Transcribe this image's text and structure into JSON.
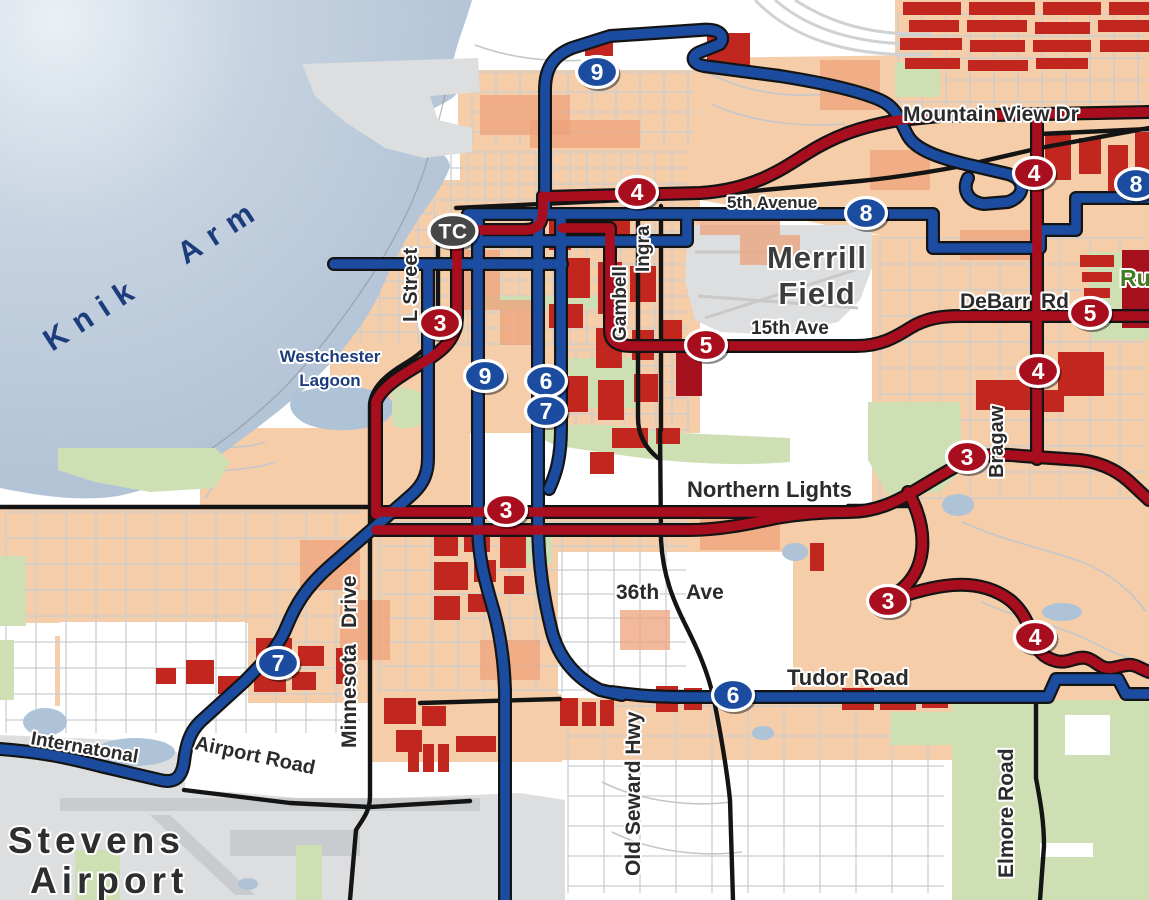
{
  "map": {
    "water": {
      "label": "Knik Arm",
      "color": "#b7c7d8"
    },
    "transit_center": {
      "label": "TC",
      "x": 453,
      "y": 231
    },
    "colors": {
      "route_red": "#a90e1e",
      "route_blue": "#1b4c9f",
      "casing_black": "#141414",
      "land_peach": "#f5cda9",
      "block_red": "#c1271f",
      "block_dark_red": "#a5121d",
      "park_green": "#cfdfb4",
      "water_blue": "#b7c7d8",
      "label_dark": "#2b2b2b",
      "label_navy": "#1d3c7c",
      "label_green": "#3e7c1f"
    },
    "route_badges": [
      {
        "route": "9",
        "color": "blue",
        "x": 597,
        "y": 72
      },
      {
        "route": "4",
        "color": "red",
        "x": 637,
        "y": 192
      },
      {
        "route": "8",
        "color": "blue",
        "x": 866,
        "y": 213
      },
      {
        "route": "8",
        "color": "blue",
        "x": 1136,
        "y": 184
      },
      {
        "route": "4",
        "color": "red",
        "x": 1034,
        "y": 173
      },
      {
        "route": "3",
        "color": "red",
        "x": 440,
        "y": 323
      },
      {
        "route": "5",
        "color": "red",
        "x": 706,
        "y": 345
      },
      {
        "route": "5",
        "color": "red",
        "x": 1090,
        "y": 313
      },
      {
        "route": "9",
        "color": "blue",
        "x": 485,
        "y": 376
      },
      {
        "route": "6",
        "color": "blue",
        "x": 546,
        "y": 381
      },
      {
        "route": "7",
        "color": "blue",
        "x": 546,
        "y": 411
      },
      {
        "route": "4",
        "color": "red",
        "x": 1038,
        "y": 371
      },
      {
        "route": "3",
        "color": "red",
        "x": 967,
        "y": 457
      },
      {
        "route": "3",
        "color": "red",
        "x": 506,
        "y": 510
      },
      {
        "route": "3",
        "color": "red",
        "x": 888,
        "y": 601
      },
      {
        "route": "4",
        "color": "red",
        "x": 1035,
        "y": 637
      },
      {
        "route": "7",
        "color": "blue",
        "x": 278,
        "y": 663
      },
      {
        "route": "6",
        "color": "blue",
        "x": 733,
        "y": 695
      }
    ],
    "place_labels": [
      {
        "id": "knik-arm",
        "text": "Knik Arm",
        "x": 52,
        "y": 352,
        "rotate": -33,
        "size": 31,
        "color": "#1d3c7c",
        "ls": 11,
        "ws": 30,
        "halo": false
      },
      {
        "id": "westchester-lagoon-1",
        "text": "Westchester",
        "x": 330,
        "y": 362,
        "size": 17,
        "color": "#1d3c7c",
        "anchor": "middle",
        "halo": true
      },
      {
        "id": "westchester-lagoon-2",
        "text": "Lagoon",
        "x": 330,
        "y": 386,
        "size": 17,
        "color": "#1d3c7c",
        "anchor": "middle",
        "halo": true
      },
      {
        "id": "merrill-field-1",
        "text": "Merrill",
        "x": 817,
        "y": 268,
        "size": 31,
        "color": "#3c3c3c",
        "anchor": "middle",
        "ls": 1,
        "halo": true
      },
      {
        "id": "merrill-field-2",
        "text": "Field",
        "x": 817,
        "y": 304,
        "size": 31,
        "color": "#3c3c3c",
        "anchor": "middle",
        "ls": 1,
        "halo": true
      },
      {
        "id": "stevens-airport-1",
        "text": "Stevens",
        "x": 8,
        "y": 853,
        "size": 37,
        "color": "#2e2e2e",
        "ls": 5,
        "halo": true
      },
      {
        "id": "stevens-airport-2",
        "text": "Airport",
        "x": 30,
        "y": 893,
        "size": 37,
        "color": "#2e2e2e",
        "ls": 5,
        "halo": true
      },
      {
        "id": "russian-jack",
        "text": "Ru",
        "x": 1120,
        "y": 286,
        "size": 23,
        "color": "#3e7c1f",
        "halo": true
      }
    ],
    "street_labels": [
      {
        "text": "Mountain View Dr",
        "x": 903,
        "y": 121,
        "size": 21
      },
      {
        "text": "5th Avenue",
        "x": 727,
        "y": 208,
        "size": 17
      },
      {
        "text": "15th Ave",
        "x": 751,
        "y": 334,
        "size": 19
      },
      {
        "text": "DeBarr",
        "x": 960,
        "y": 308,
        "size": 21
      },
      {
        "text": "Rd",
        "x": 1041,
        "y": 308,
        "size": 21
      },
      {
        "text": "Northern Lights",
        "x": 687,
        "y": 497,
        "size": 22
      },
      {
        "text": "36th",
        "x": 616,
        "y": 599,
        "size": 21
      },
      {
        "text": "Ave",
        "x": 686,
        "y": 599,
        "size": 21
      },
      {
        "text": "Tudor Road",
        "x": 787,
        "y": 685,
        "size": 22
      },
      {
        "text": "Internatonal",
        "x": 30,
        "y": 744,
        "size": 19,
        "rotate": 10
      },
      {
        "text": "Airport Road",
        "x": 194,
        "y": 749,
        "size": 20,
        "rotate": 12
      },
      {
        "text": "L Street",
        "x": 417,
        "y": 322,
        "rotate": -90,
        "size": 20
      },
      {
        "text": "Gambell",
        "x": 626,
        "y": 341,
        "rotate": -90,
        "size": 19
      },
      {
        "text": "Ingra",
        "x": 649,
        "y": 272,
        "rotate": -90,
        "size": 19
      },
      {
        "text": "Minnesota",
        "x": 356,
        "y": 748,
        "rotate": -90,
        "size": 21
      },
      {
        "text": "Drive",
        "x": 356,
        "y": 628,
        "rotate": -90,
        "size": 21
      },
      {
        "text": "Old Seward Hwy",
        "x": 640,
        "y": 876,
        "rotate": -90,
        "size": 21
      },
      {
        "text": "Elmore Road",
        "x": 1013,
        "y": 878,
        "rotate": -90,
        "size": 21
      },
      {
        "text": "Bragaw",
        "x": 1003,
        "y": 478,
        "rotate": -90,
        "size": 20
      }
    ],
    "routes": [
      {
        "id": "blue-9-north-loop",
        "color": "blue",
        "d": "M545,214 L545,90 C545,70 552,56 572,48 L610,36 L700,30 C720,28 726,36 720,44 L700,52 C690,56 692,64 704,66 L780,76 C830,84 862,92 880,100 C898,108 900,122 908,136 C916,150 940,158 965,164 L1008,174 C1026,179 1026,196 1008,202 L984,204 C968,202 962,190 968,178"
      },
      {
        "id": "blue-8-6th-ave",
        "color": "blue",
        "d": "M468,214 L933,214 L933,248 L1040,248 L1040,230 L1076,230 L1076,198 L1149,198"
      },
      {
        "id": "blue-5th-parallel",
        "color": "blue",
        "d": "M478,241 L687,241 L687,215"
      },
      {
        "id": "blue-9th-ave",
        "color": "blue",
        "d": "M334,264 L562,264"
      },
      {
        "id": "blue-9-south",
        "color": "blue",
        "d": "M478,214 L478,524 C478,560 486,584 494,612 C500,634 504,660 505,690 L505,900"
      },
      {
        "id": "blue-6-a-street",
        "color": "blue",
        "d": "M538,214 L538,520 C538,566 544,600 552,632 C559,658 576,678 600,690 L622,695"
      },
      {
        "id": "blue-7-c-street",
        "color": "blue",
        "d": "M561,214 L561,428 C561,458 556,474 549,489"
      },
      {
        "id": "blue-7-spenard",
        "color": "blue",
        "d": "M428,264 L428,458 C428,478 420,488 408,498 L330,566 C305,588 295,606 286,628 C278,648 262,664 244,682 L200,722 C190,732 186,744 184,762 C182,776 176,784 160,780 L100,766 C65,757 40,752 0,749"
      },
      {
        "id": "blue-6-tudor",
        "color": "blue",
        "d": "M612,692 C640,696 660,697 690,697 L1048,697 L1056,679 L1118,679 L1126,694 L1149,694"
      },
      {
        "id": "red-3-l-street",
        "color": "red",
        "d": "M457,224 L457,316 C457,338 444,350 424,362 C404,374 382,386 376,402 L376,514"
      },
      {
        "id": "red-tc-connector",
        "color": "red",
        "d": "M457,230 L524,230 C540,230 543,222 543,206 L543,196"
      },
      {
        "id": "red-4-5th-glenn",
        "color": "red",
        "d": "M543,197 L700,193 C750,190 778,172 806,154 C834,136 862,126 900,120 L940,116 L1149,112"
      },
      {
        "id": "red-4-bragaw",
        "color": "red",
        "d": "M1037,117 L1037,459"
      },
      {
        "id": "red-5-gambell-debarr",
        "color": "red",
        "d": "M562,228 L610,228 L610,330 C610,342 618,346 632,346 L856,346 C880,346 894,338 910,328 C926,318 942,316 960,316 L1149,316"
      },
      {
        "id": "red-3-northern-lights",
        "color": "red",
        "d": "M376,512 L848,512 C876,512 896,502 916,490 C936,478 952,468 968,460 C984,454 1002,454 1022,456 L1080,460 C1106,463 1122,474 1134,486 L1149,500"
      },
      {
        "id": "red-benson",
        "color": "red",
        "d": "M376,530 L688,530 C720,530 748,524 776,518 C800,514 824,512 848,512"
      },
      {
        "id": "red-3-lake-otis-tudor",
        "color": "red",
        "d": "M908,492 C918,510 924,530 922,550 C920,568 912,582 898,592 C890,598 884,602 878,604 C900,597 922,589 944,586 C972,582 994,588 1010,600 C1022,610 1028,622 1032,636 C1036,650 1044,658 1056,661 C1068,664 1076,656 1086,658 C1096,660 1100,670 1112,668 C1124,666 1130,662 1140,668 L1149,672"
      }
    ],
    "major_roads": [
      {
        "id": "glenn-hwy-5th",
        "d": "M456,208 L688,197 L860,181 C900,177 930,172 962,166 L1040,148 L1149,128"
      },
      {
        "id": "gambell-st",
        "d": "M638,206 L638,418 C638,438 648,450 658,458"
      },
      {
        "id": "ingra-st",
        "d": "M661,206 L661,430"
      },
      {
        "id": "new-seward-hwy",
        "d": "M660,430 L661,540 C663,576 673,600 686,626 C698,650 708,672 714,700 C720,730 726,762 730,800 L733,900"
      },
      {
        "id": "l-st-minnesota-dr",
        "d": "M438,230 L438,316 C438,340 424,352 404,364 C384,376 372,388 370,404 L370,796 C370,812 362,820 356,830 L350,900"
      },
      {
        "id": "northern-lights-west",
        "d": "M0,507 L370,507"
      },
      {
        "id": "northern-lights-east-stub",
        "d": "M848,506 L920,506"
      },
      {
        "id": "intl-airport-road",
        "d": "M184,790 L290,803 L370,807 L470,801"
      },
      {
        "id": "tudor-west",
        "d": "M420,703 L560,699"
      },
      {
        "id": "elmore-road",
        "d": "M1036,700 L1036,778 C1040,800 1044,820 1044,846 L1040,900"
      },
      {
        "id": "mountain-view-dr-east",
        "d": "M1040,134 L1149,129"
      }
    ]
  }
}
